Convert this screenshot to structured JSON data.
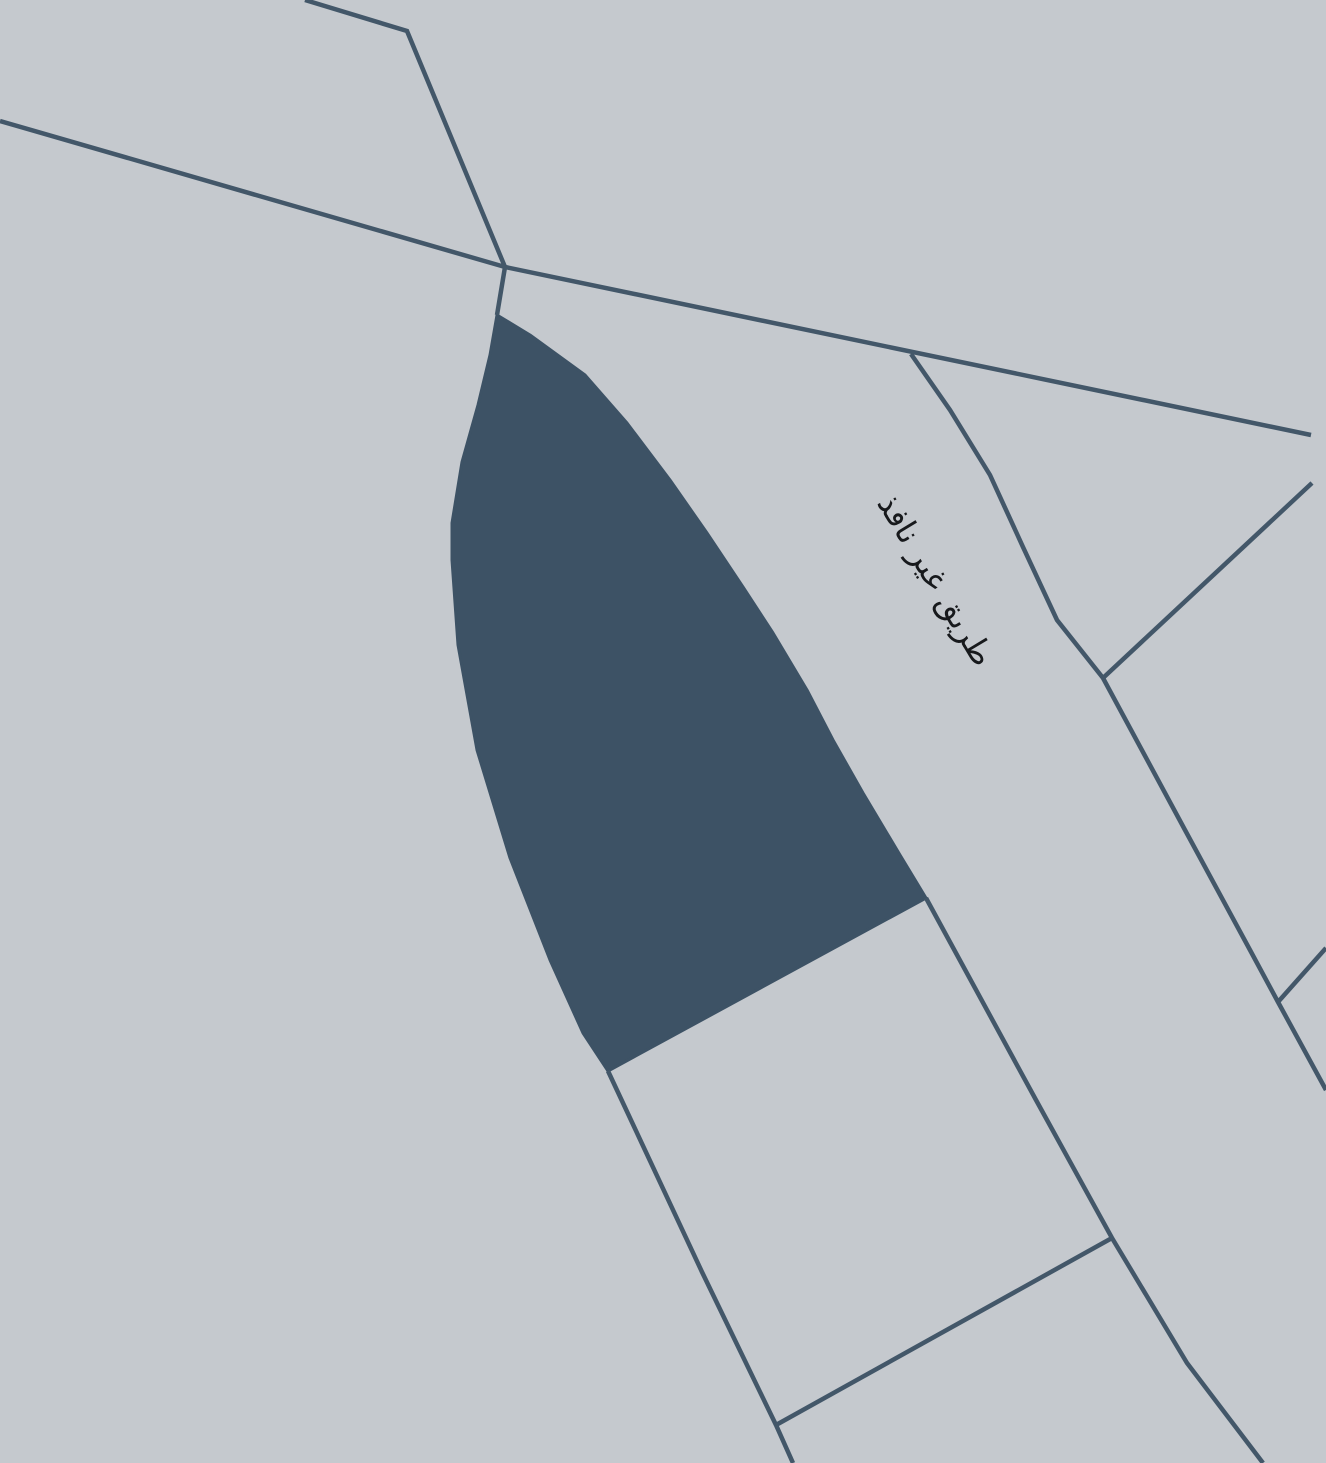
{
  "map": {
    "width": 1326,
    "height": 1463,
    "background_color": "#c5c9ce",
    "parcel_fill_color": "#3d5265",
    "road_line_color": "#435769",
    "road_line_width": 4.5,
    "parcel_stroke_width": 3,
    "label": {
      "text": "طريق غير نافذ",
      "color": "#17191c",
      "font_size": 32,
      "center_x": 936,
      "center_y": 580,
      "rotation_deg": 59
    },
    "geometry": {
      "selected_parcel": [
        [
          497,
          315
        ],
        [
          530,
          335
        ],
        [
          585,
          375
        ],
        [
          627,
          423
        ],
        [
          670,
          480
        ],
        [
          707,
          533
        ],
        [
          743,
          587
        ],
        [
          773,
          633
        ],
        [
          807,
          690
        ],
        [
          833,
          740
        ],
        [
          863,
          793
        ],
        [
          900,
          855
        ],
        [
          926,
          898
        ],
        [
          608,
          1071
        ],
        [
          583,
          1033
        ],
        [
          550,
          960
        ],
        [
          510,
          858
        ],
        [
          477,
          750
        ],
        [
          458,
          645
        ],
        [
          452,
          560
        ],
        [
          452,
          523
        ],
        [
          462,
          462
        ],
        [
          478,
          405
        ],
        [
          490,
          355
        ]
      ],
      "roads": [
        {
          "id": "road-top-left",
          "points": [
            [
              305,
              0
            ],
            [
              407,
              31
            ],
            [
              505,
              267
            ]
          ]
        },
        {
          "id": "road-main-diagonal",
          "points": [
            [
              0,
              121
            ],
            [
              505,
              267
            ],
            [
              1311,
              435
            ]
          ]
        },
        {
          "id": "road-junction-to-parcel",
          "points": [
            [
              505,
              267
            ],
            [
              497,
              315
            ]
          ]
        },
        {
          "id": "road-dead-end-east",
          "points": [
            [
              911,
              354
            ],
            [
              950,
              410
            ],
            [
              990,
              475
            ],
            [
              1023,
              547
            ],
            [
              1057,
              620
            ],
            [
              1103,
              678
            ],
            [
              1185,
              830
            ],
            [
              1250,
              950
            ],
            [
              1278,
              1002
            ],
            [
              1326,
              1090
            ]
          ]
        },
        {
          "id": "road-northeast-spur",
          "points": [
            [
              1312,
              483
            ],
            [
              1103,
              678
            ]
          ]
        },
        {
          "id": "road-east-spur",
          "points": [
            [
              1278,
              1002
            ],
            [
              1326,
              948
            ]
          ]
        },
        {
          "id": "road-parcel-tip-south",
          "points": [
            [
              608,
              1071
            ],
            [
              702,
              1272
            ],
            [
              776,
              1425
            ],
            [
              793,
              1463
            ]
          ]
        },
        {
          "id": "boundary-south-cross",
          "points": [
            [
              776,
              1425
            ],
            [
              1112,
              1238
            ]
          ]
        },
        {
          "id": "boundary-parcel-southeast",
          "points": [
            [
              926,
              898
            ],
            [
              1036,
              1100
            ],
            [
              1112,
              1238
            ],
            [
              1187,
              1363
            ],
            [
              1263,
              1463
            ]
          ]
        }
      ]
    }
  }
}
